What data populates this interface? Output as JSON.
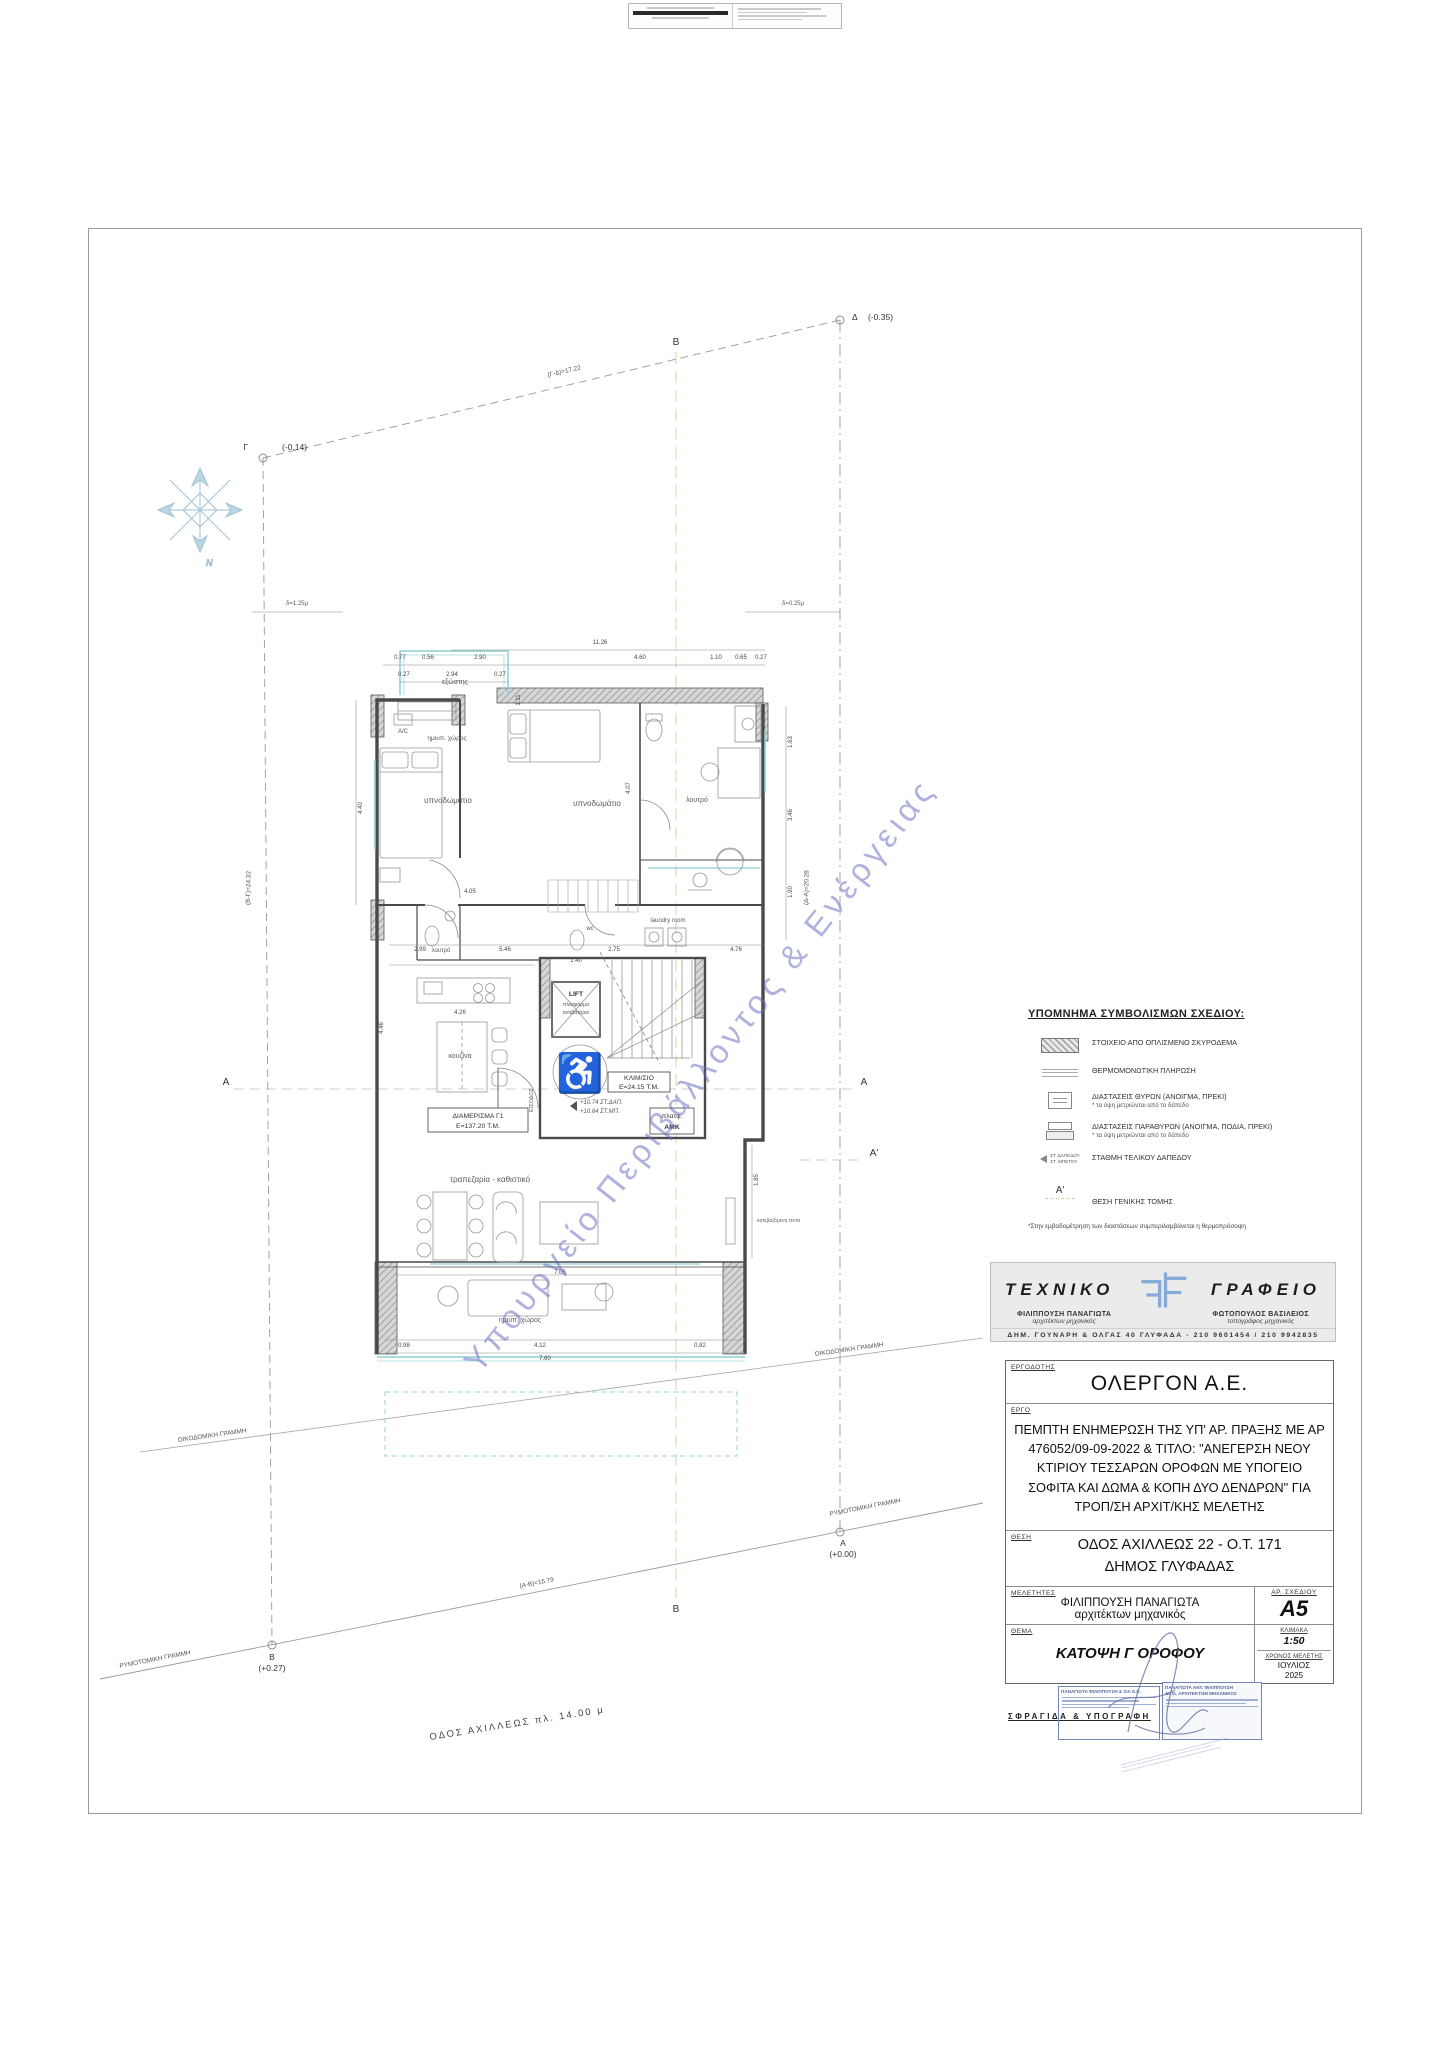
{
  "watermark": "Υπουργείο Περιβάλλοντος & Ενέργειας",
  "site": {
    "corners": {
      "gamma": "Γ",
      "gamma_level": "(-0.14)",
      "delta": "Δ",
      "delta_level": "(-0.35)",
      "beta": "Β",
      "beta_level": "(+0.27)",
      "alpha": "Α",
      "alpha_level": "(+0.00)"
    },
    "edges": {
      "top": "(Γ-Δ)=17.22",
      "bottom": "(Α-Β)=16.79",
      "left": "(Β-Γ)=24.32",
      "right": "(Δ-Α)=20.28"
    },
    "setback_left": "δ=1.25μ",
    "setback_right": "δ=0.25μ",
    "building_line": "ΟΙΚΟΔΟΜΙΚΗ ΓΡΑΜΜΗ",
    "street_line": "ΡΥΜΟΤΟΜΙΚΗ ΓΡΑΜΜΗ",
    "street": "ΟΔΟΣ ΑΧΙΛΛΕΩΣ   πλ. 14.00 μ",
    "north": "N",
    "section_b": "Β",
    "section_a": "Α",
    "section_a_prime": "Α'"
  },
  "plan": {
    "rooms": {
      "bedroom_left": "υπνοδωμάτιο",
      "bedroom_right": "υπνοδωμάτιο",
      "balcony_top": "εξώστης",
      "semiopen_top": "ημιυπ. χώρος",
      "ac": "A/C",
      "kitchen": "κουζίνα",
      "bath_mid": "λουτρό",
      "bath_right": "λουτρό",
      "wc": "wc",
      "laundry": "laundry room",
      "living": "τραπεζαρία - καθιστικό",
      "semiopen_bottom": "ημιυπ. χώρος",
      "entrance": "ΕΙΣΟΔΟΣ",
      "tent": "κατεβαζόμενη τέντα"
    },
    "apartment_box": {
      "line1": "ΔΙΑΜΕΡΙΣΜΑ Γ1",
      "line2": "Ε=137.20 Τ.Μ."
    },
    "stair_box": {
      "line1": "ΚΛΙΜ/ΣΙΟ",
      "line2": "Ε=24.15 Τ.Μ."
    },
    "lift_box": {
      "line1": "LIFT",
      "line2": "πλατφόρμα",
      "line3": "αναβατόριο"
    },
    "amk_box": {
      "line1": "πλατφ.",
      "line2": "ΑΜΚ"
    },
    "levels": {
      "line1": "+10.74 ΣΤ.ΔΑΠ.",
      "line2": "+10.64 ΣΤ.ΜΠ."
    },
    "icons": {
      "wheelchair": "♿"
    },
    "dims": [
      {
        "t": "11.26",
        "x": 600,
        "y": 644
      },
      {
        "t": "0.77",
        "x": 400,
        "y": 659
      },
      {
        "t": "0.56",
        "x": 428,
        "y": 659
      },
      {
        "t": "2.90",
        "x": 480,
        "y": 659
      },
      {
        "t": "4.60",
        "x": 640,
        "y": 659
      },
      {
        "t": "1.10",
        "x": 716,
        "y": 659
      },
      {
        "t": "0.65",
        "x": 741,
        "y": 659
      },
      {
        "t": "0.27",
        "x": 761,
        "y": 659
      },
      {
        "t": "0.27",
        "x": 404,
        "y": 676
      },
      {
        "t": "2.94",
        "x": 452,
        "y": 676
      },
      {
        "t": "0.27",
        "x": 500,
        "y": 676
      },
      {
        "t": "1.11",
        "x": 520,
        "y": 700,
        "r": -90
      },
      {
        "t": "4.40",
        "x": 362,
        "y": 808,
        "r": -90
      },
      {
        "t": "4.05",
        "x": 470,
        "y": 893
      },
      {
        "t": "4.46",
        "x": 383,
        "y": 1028,
        "r": -90
      },
      {
        "t": "4.26",
        "x": 460,
        "y": 1014
      },
      {
        "t": "1.40",
        "x": 576,
        "y": 962
      },
      {
        "t": "4.07",
        "x": 630,
        "y": 788,
        "r": -90
      },
      {
        "t": "1.63",
        "x": 792,
        "y": 742,
        "r": -90
      },
      {
        "t": "3.46",
        "x": 792,
        "y": 815,
        "r": -90
      },
      {
        "t": "1.90",
        "x": 792,
        "y": 892,
        "r": -90
      },
      {
        "t": "2.99",
        "x": 420,
        "y": 951
      },
      {
        "t": "5.46",
        "x": 505,
        "y": 951
      },
      {
        "t": "2.75",
        "x": 614,
        "y": 951
      },
      {
        "t": "4.76",
        "x": 736,
        "y": 951
      },
      {
        "t": "7.05",
        "x": 560,
        "y": 1274
      },
      {
        "t": "0.98",
        "x": 404,
        "y": 1347
      },
      {
        "t": "4.12",
        "x": 540,
        "y": 1347
      },
      {
        "t": "0.82",
        "x": 700,
        "y": 1347
      },
      {
        "t": "7.60",
        "x": 545,
        "y": 1360
      },
      {
        "t": "1.85",
        "x": 758,
        "y": 1180,
        "r": -90
      }
    ]
  },
  "legend": {
    "title": "ΥΠΟΜΝΗΜΑ ΣΥΜΒΟΛΙΣΜΩΝ ΣΧΕΔΙΟΥ:",
    "items": [
      {
        "text": "ΣΤΟΙΧΕΙΟ ΑΠΟ ΟΠΛΙΣΜΕΝΟ ΣΚΥΡΟΔΕΜΑ",
        "sub": ""
      },
      {
        "text": "ΘΕΡΜΟΜΟΝΩΤΙΚΗ ΠΛΗΡΩΣΗ",
        "sub": ""
      },
      {
        "text": "ΔΙΑΣΤΑΣΕΙΣ ΘΥΡΩΝ (ΑΝΟΙΓΜΑ, ΠΡΕΚΙ)",
        "sub": "* τα ύψη μετριώνται από το δάπεδο"
      },
      {
        "text": "ΔΙΑΣΤΑΣΕΙΣ ΠΑΡΑΘΥΡΩΝ (ΑΝΟΙΓΜΑ, ΠΟΔΙΑ, ΠΡΕΚΙ)",
        "sub": "* τα ύψη μετριώνται από το δάπεδο"
      },
      {
        "text": "ΣΤΑΘΜΗ ΤΕΛΙΚΟΥ ΔΑΠΕΔΟΥ",
        "sub": ""
      },
      {
        "text": "ΘΕΣΗ ΓΕΝΙΚΗΣ ΤΟΜΗΣ",
        "sub": ""
      }
    ],
    "level_symbol": {
      "line1": "ΣΤ. ΔΑΠΕΔΟΥ",
      "line2": "ΣΤ. ΜΠΕΤΟΥ"
    },
    "section_symbol": "Α'",
    "footnote": "*Στην εμβαδομέτρηση των διαστάσεων συμπεριλαμβάνεται η θερμοπρόσοψη"
  },
  "office": {
    "name_left": "ΤΕΧΝΙΚΟ",
    "name_right": "ΓΡΑΦΕΙΟ",
    "person1": {
      "name": "ΦΙΛΙΠΠΟΥΣΗ ΠΑΝΑΓΙΩΤΑ",
      "title": "αρχιτέκτων μηχανικός"
    },
    "person2": {
      "name": "ΦΩΤΟΠΟΥΛΟΣ ΒΑΣΙΛΕΙΟΣ",
      "title": "τοπογράφος μηχανικός"
    },
    "address": "ΔΗΜ. ΓΟΥΝΑΡΗ & ΟΛΓΑΣ 40 ΓΛΥΦΑΔΑ  -  210 9601454 / 210 9942835"
  },
  "titleblock": {
    "owner_label": "ΕΡΓΟΔΟΤΗΣ",
    "owner": "ΟΛΕΡΓΟΝ Α.Ε.",
    "project_label": "ΕΡΓΟ",
    "project": "ΠΕΜΠΤΗ ΕΝΗΜΕΡΩΣΗ ΤΗΣ ΥΠ' ΑΡ. ΠΡΑΞΗΣ ΜΕ ΑΡ 476052/09-09-2022 & ΤΙΤΛΟ: \"ΑΝΕΓΕΡΣΗ ΝΕΟΥ ΚΤΙΡΙΟΥ ΤΕΣΣΑΡΩΝ ΟΡΟΦΩΝ ΜΕ ΥΠΟΓΕΙΟ ΣΟΦΙΤΑ ΚΑΙ ΔΩΜΑ & ΚΟΠΗ ΔΥΟ ΔΕΝΔΡΩΝ\" ΓΙΑ ΤΡΟΠ/ΣΗ ΑΡΧΙΤ/ΚΗΣ  ΜΕΛΕΤΗΣ",
    "location_label": "ΘΕΣΗ",
    "location_line1": "ΟΔΟΣ ΑΧΙΛΛΕΩΣ 22 - Ο.Τ. 171",
    "location_line2": "ΔΗΜΟΣ ΓΛΥΦΑΔΑΣ",
    "designers_label": "ΜΕΛΕΤΗΤΕΣ",
    "designer_name": "ΦΙΛΙΠΠΟΥΣΗ ΠΑΝΑΓΙΩΤΑ",
    "designer_title": "αρχιτέκτων μηχανικός",
    "drawing_no_label": "ΑΡ. ΣΧΕΔΙΟΥ",
    "drawing_no": "A5",
    "subject_label": "ΘΕΜΑ",
    "subject": "ΚΑΤΟΨΗ Γ ΟΡΟΦΟΥ",
    "scale_label": "ΚΛΙΜΑΚΑ",
    "scale": "1:50",
    "date_label": "ΧΡΟΝΟΣ ΜΕΛΕΤΗΣ",
    "date_month": "ΙΟΥΛΙΟΣ",
    "date_year": "2025",
    "stamp_label": "ΣΦΡΑΓΙΔΑ & ΥΠΟΓΡΑΦΗ",
    "stamp_left_line1": "ΠΑΝΑΓΙΩΤΑ ΦΙΛΙΠΠΟΥΣΗ & ΣΙΑ Ε.Ε.",
    "stamp_right_line1": "ΠΑΝΑΓΙΩΤΑ ΑΝΤ. ΦΙΛΙΠΠΟΥΣΗ",
    "stamp_right_line2": "ΔΙΠΛ. ΑΡΧΙΤΕΚΤΩΝ ΜΗΧΑΝΙΚΟΣ"
  }
}
